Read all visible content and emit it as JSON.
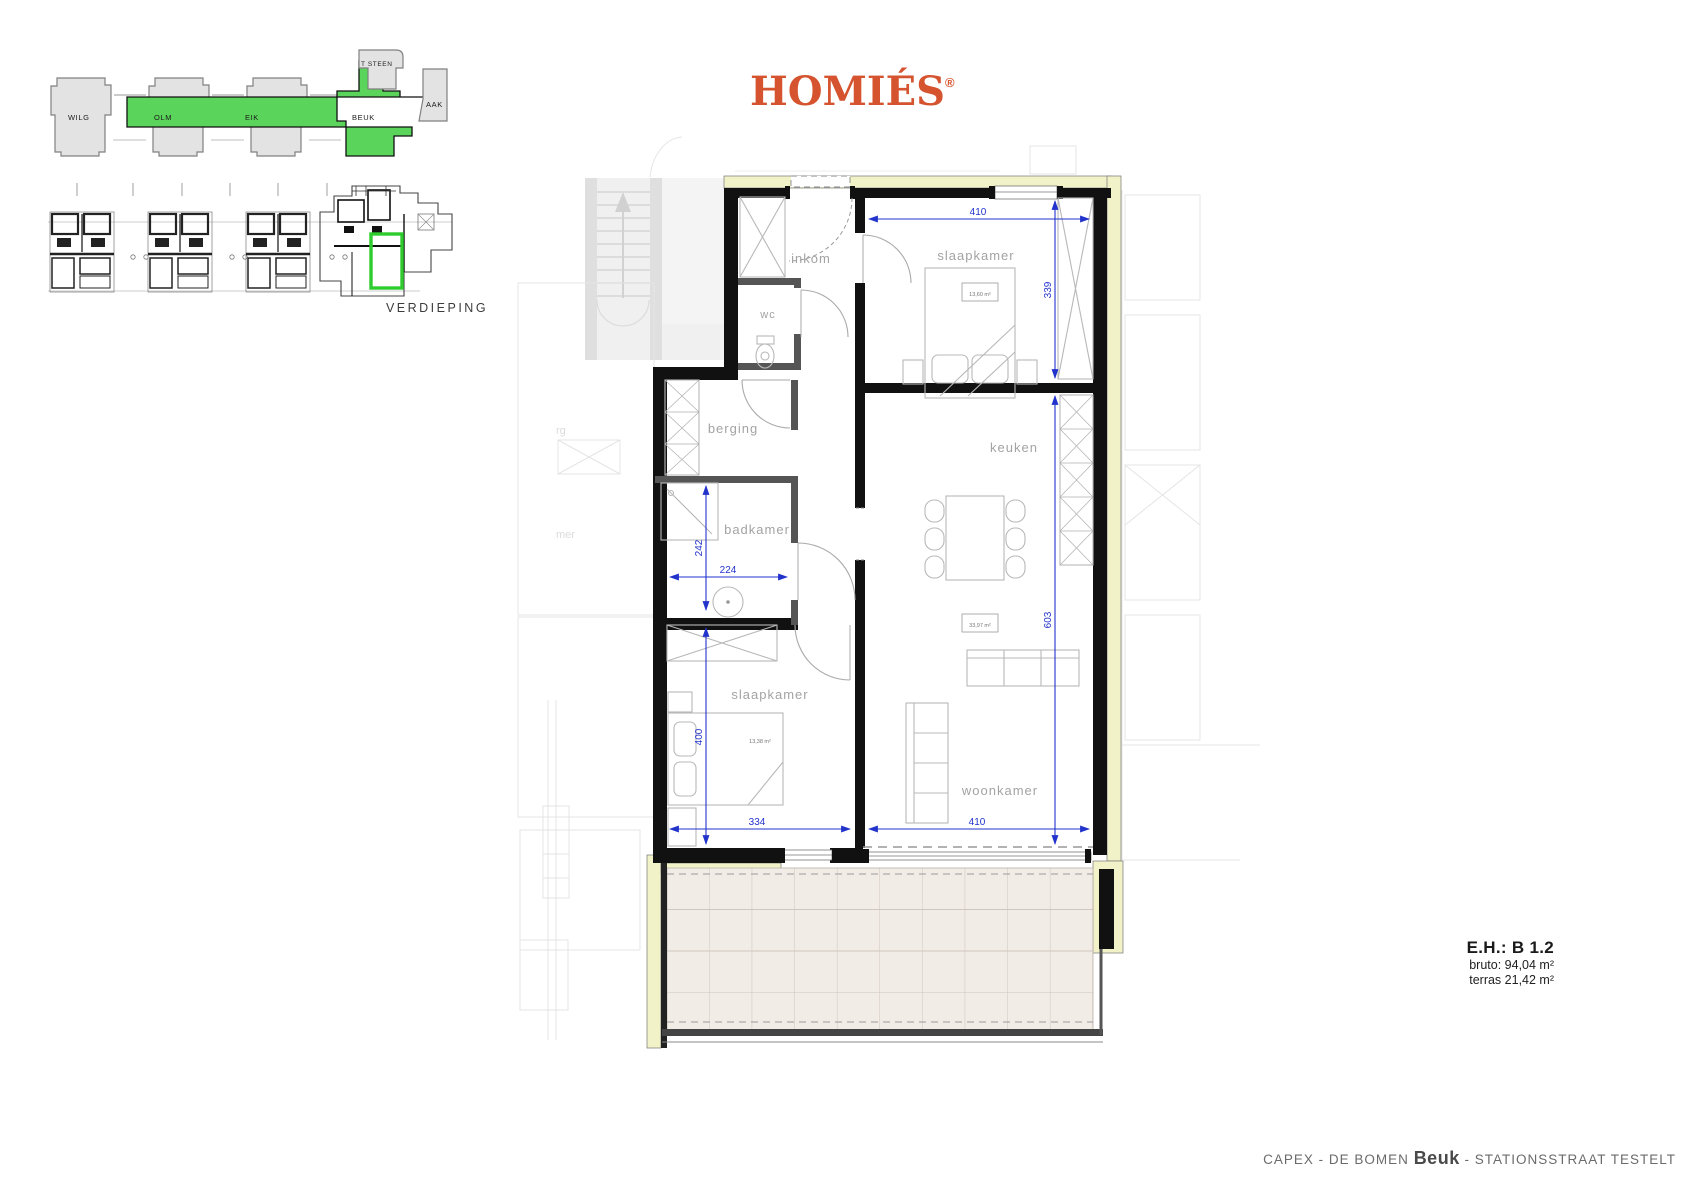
{
  "logo": {
    "brand": "HOMIÉS",
    "registered_mark": "®"
  },
  "site_plan": {
    "buildings": {
      "wilg": "WILG",
      "olm": "OLM",
      "eik": "EIK",
      "beuk": "BEUK",
      "tsteen": "T STEEN",
      "aak": "AAK"
    },
    "highlighted_building": "BEUK"
  },
  "floor_overview": {
    "label": "VERDIEPING"
  },
  "rooms": {
    "inkom": "inkom",
    "wc": "wc",
    "berging": "berging",
    "badkamer": "badkamer",
    "slaapkamer_1": "slaapkamer",
    "slaapkamer_2": "slaapkamer",
    "keuken": "keuken",
    "woonkamer": "woonkamer"
  },
  "areas": {
    "s1": "13,60 m²",
    "wk": "33,97 m²",
    "s2": "13,38 m²"
  },
  "dims": {
    "w410a": "410",
    "h339": "339",
    "h603": "603",
    "h242": "242",
    "w224": "224",
    "h400": "400",
    "w334": "334",
    "w410b": "410"
  },
  "unit_info": {
    "code": "E.H.: B 1.2",
    "bruto": "bruto: 94,04 m²",
    "terras": "terras 21,42 m²"
  },
  "footer": {
    "project": "CAPEX - DE BOMEN",
    "building": "Beuk",
    "suffix": "- STATIONSSTRAAT TESTELT"
  },
  "colors": {
    "accent_orange": "#d5532e",
    "highlight_green": "#45d145",
    "dimension_blue": "#2233cc",
    "exterior_yellow": "#f2f2c9"
  }
}
